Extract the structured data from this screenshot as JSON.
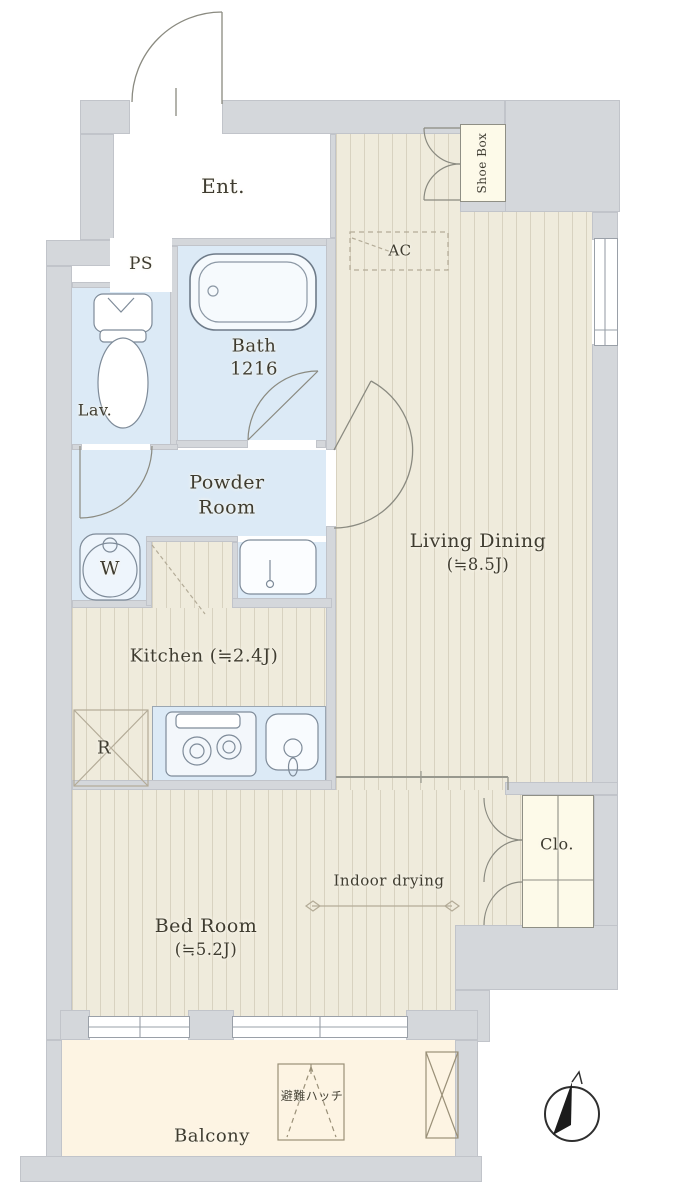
{
  "plan": {
    "type": "apartment-floor-plan",
    "rooms": {
      "entrance": "Ent.",
      "pipe_shaft": "PS",
      "lavatory": "Lav.",
      "bath_line1": "Bath",
      "bath_line2": "1216",
      "powder_line1": "Powder",
      "powder_line2": "Room",
      "washer": "W",
      "kitchen": "Kitchen (≒2.4J)",
      "fridge": "R",
      "ac": "AC",
      "shoe_box": "Shoe Box",
      "living_line1": "Living Dining",
      "living_line2": "(≒8.5J)",
      "closet": "Clo.",
      "indoor_drying": "Indoor drying",
      "bedroom_line1": "Bed Room",
      "bedroom_line2": "(≒5.2J)",
      "balcony": "Balcony",
      "evacuation_hatch": "避難ハッチ"
    },
    "colors": {
      "wood_floor": "#efebdc",
      "wet_area": "#dceaf6",
      "balcony": "#fdf4e3",
      "wall": "#d4d7db",
      "storage": "#fdfae9"
    }
  }
}
